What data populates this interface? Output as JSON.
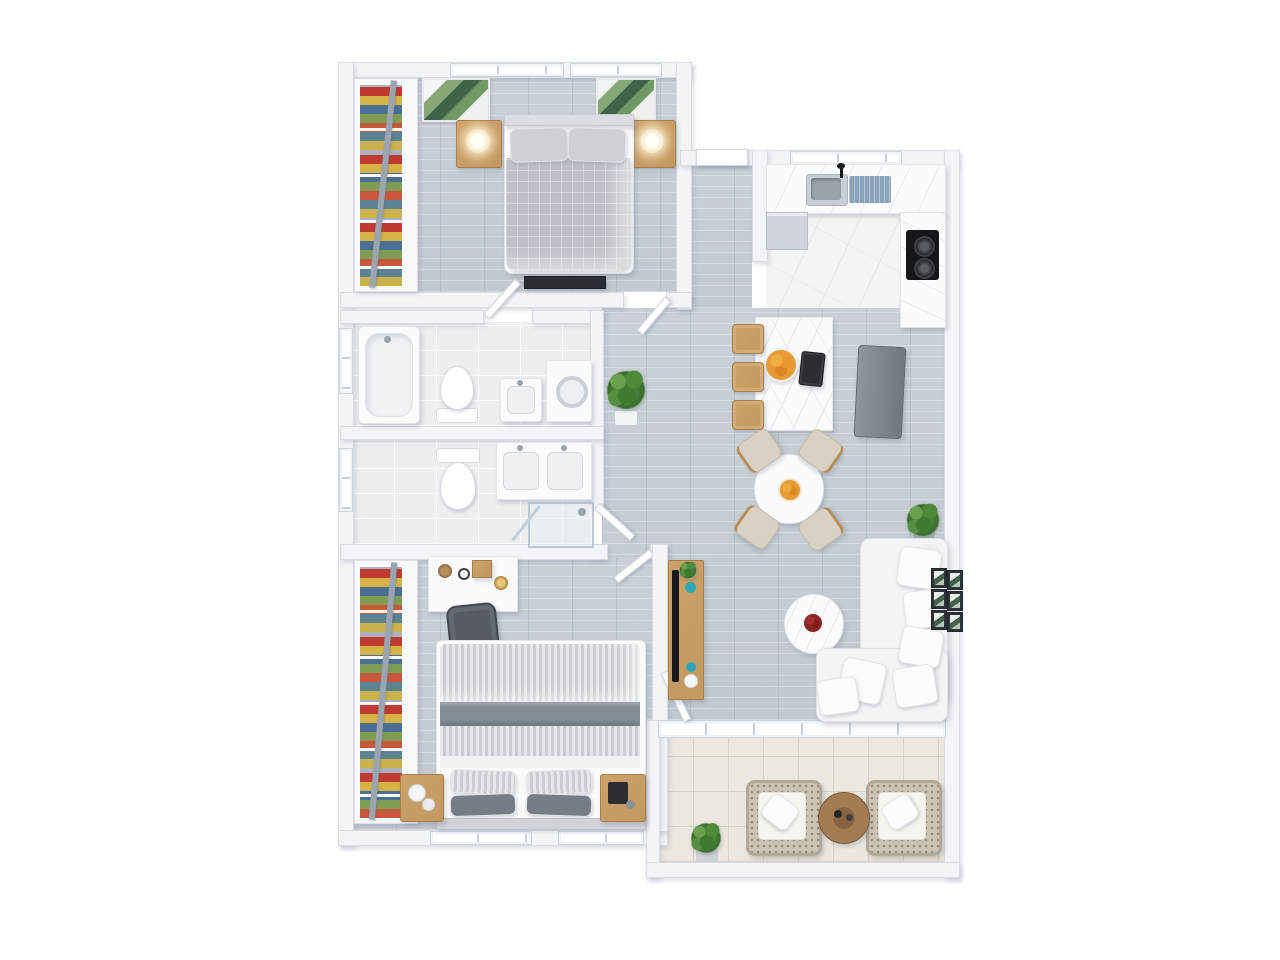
{
  "scene": {
    "kind": "3d-floor-plan-render",
    "view": "top-down",
    "background": "#ffffff"
  },
  "palette": {
    "wall": "#f2f4f7",
    "wall_edge": "#d9dde2",
    "wood_floor": "#c7cdd3",
    "marble_floor": "#f3f4f6",
    "bath_tile": "#eceef1",
    "balcony_tile": "#ece8e1",
    "oak_furniture": "#c49a63",
    "appliance_gray": "#7b838d",
    "sofa_white": "#f3f4f6",
    "duvet_gray": "#bdc1c7",
    "blanket_gray": "#868d96",
    "teal_decor": "#2fa8b5",
    "orange_fruit": "#e89a33",
    "flower_red": "#8c2422",
    "plant_green": "#4c8a3c",
    "tv_black": "#17191c",
    "drainboard_blue": "#8ba3bb"
  },
  "entry": {
    "front_door": "front door opening",
    "hallway_floor": "entry hall, wood floor"
  },
  "rooms": {
    "master_bedroom": {
      "label": "master bedroom",
      "items": {
        "bed": "double bed with gray duvet and two pillows",
        "headboard": "headboard",
        "nightstand_left": "wood nightstand with lamp",
        "nightstand_right": "wood nightstand with lamp",
        "wall_art_left": "palm leaf wall art",
        "wall_art_right": "palm leaf wall art",
        "wardrobe": "open wardrobe with colorful clothes",
        "media_bench": "low media bench",
        "windows": "double window",
        "door": "door to hallway"
      }
    },
    "kitchen": {
      "label": "kitchen",
      "items": {
        "counter": "marble countertop",
        "sink": "stainless sink with drainboard and faucet",
        "dishwasher": "built-in dishwasher",
        "cooktop": "gas cooktop, two burners",
        "fridge": "gray refrigerator",
        "island": "marble kitchen island",
        "bar_stools": "three wood bar stools",
        "fruit_bowl": "bowl of oranges",
        "coffee_maker": "black coffee maker",
        "windows": "kitchen window"
      }
    },
    "dining_area": {
      "label": "dining area",
      "items": {
        "table": "round white dining table",
        "chairs": "four beige dining chairs",
        "fruit_plate": "plate of oranges",
        "plant": "potted plant in corner"
      }
    },
    "living_area": {
      "label": "living area",
      "items": {
        "sofa": "white L-shaped sectional sofa with pillows",
        "coffee_table": "round white coffee table",
        "flowers": "red flower centerpiece",
        "tv_console": "wood TV console with teal decor",
        "tv": "flat screen TV",
        "console_plant": "small plant on console",
        "gallery_wall": "gallery wall of six framed prints",
        "balcony_door": "open balcony door",
        "window_band": "window wall to balcony"
      }
    },
    "balcony": {
      "label": "balcony",
      "items": {
        "armchair_left": "wicker armchair with white cushion",
        "armchair_right": "wicker armchair with white cushion",
        "side_table": "round wood side table with candles",
        "plant": "potted plant"
      }
    },
    "bathroom_main": {
      "label": "main bathroom",
      "items": {
        "bathtub": "bathtub",
        "toilet": "toilet",
        "sink": "washbasin",
        "washer": "washing machine",
        "window": "frosted window",
        "door": "door to hallway"
      }
    },
    "bathroom_second": {
      "label": "second bathroom",
      "items": {
        "toilet": "toilet",
        "double_vanity": "double sink vanity",
        "shower": "glass shower enclosure",
        "window": "frosted window",
        "door": "door to hallway"
      }
    },
    "hallway": {
      "label": "hallway",
      "items": {
        "plant": "potted plant"
      }
    },
    "second_bedroom": {
      "label": "second bedroom",
      "items": {
        "bed": "double bed with striped linen and gray blanket",
        "pillows": "striped and gray pillows",
        "nightstand_left": "wood nightstand",
        "nightstand_right": "wood nightstand",
        "desk": "white desk with decor",
        "desk_chair": "dark gray desk chair",
        "wardrobe": "open wardrobe with colorful clothes",
        "windows": "double window",
        "door": "door to hallway"
      }
    }
  }
}
